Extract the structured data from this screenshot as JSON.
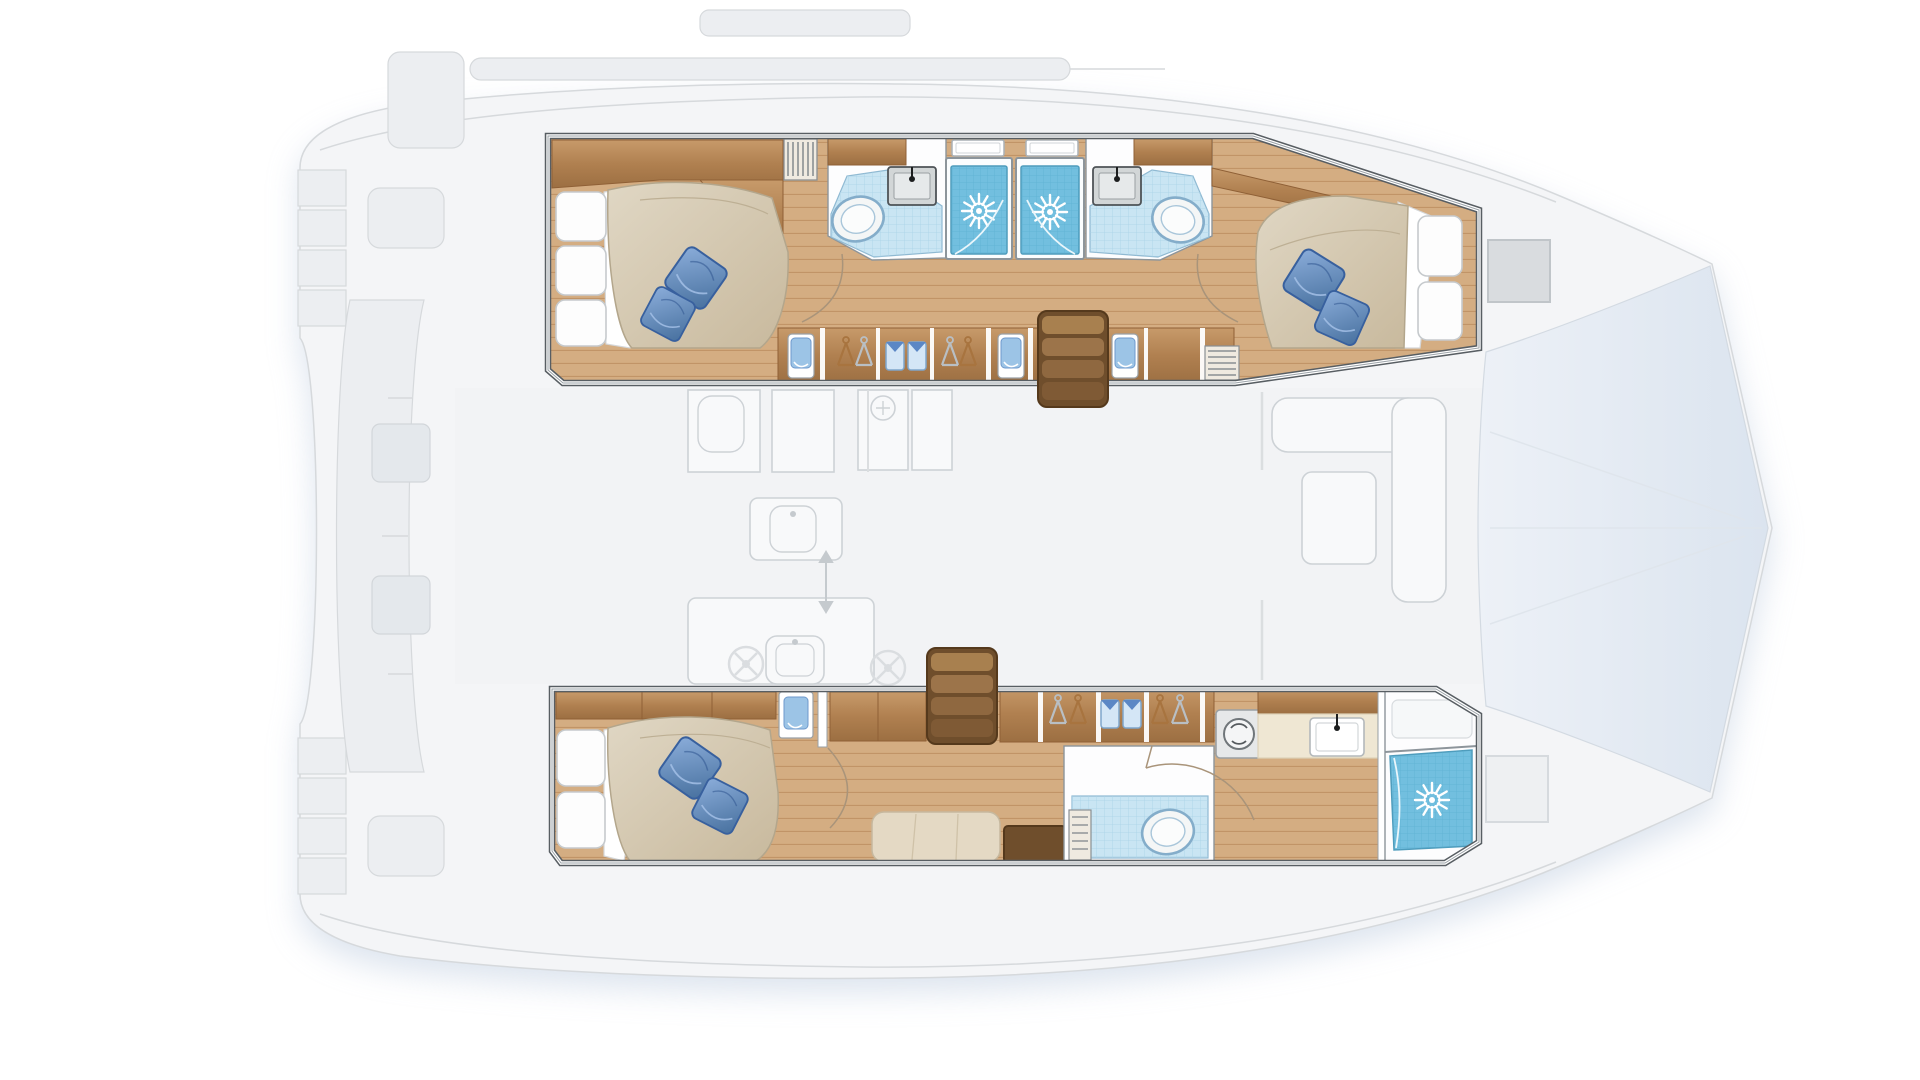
{
  "image": {
    "kind": "yacht-interior-floor-plan",
    "vessel": "sailing-catamaran",
    "view": "top-down-deck-plan",
    "orientation": "bow-right-stern-left"
  },
  "palette": {
    "wood_hi": "#c79a6a",
    "wood_mid": "#b08050",
    "wood_dark": "#8f6036",
    "wood_floor": "#d4ad82",
    "wood_floor_line": "#c19467",
    "wood_stair": "#6f4e2c",
    "duvet": "#d5c9b2",
    "duvet_line": "#b3a68c",
    "pillow_blue": "#5b87c5",
    "pillow_blue_dark": "#38609e",
    "bath_floor": "#c9e5f3",
    "shower_tile": "#72bfdf",
    "fixture_line": "#84adca",
    "sink_gray": "#d2d6d7",
    "frame_gray": "#8d959b",
    "box_border": "#585e63",
    "box_inner": "#9aa1a7",
    "fade_fill": "#f4f5f7",
    "fade_fill2": "#eceef1",
    "fade_line": "#d6d9dc",
    "salon_line": "#aab2b8",
    "shadow": "#bfcde0",
    "cream": "#efe7d3",
    "shirt_blue": "#d4e6f6",
    "hanger_tan": "#a8743f",
    "hanger_silver": "#b9bfc4"
  },
  "layout": {
    "port_hull": {
      "position": "top",
      "rooms": [
        {
          "name": "aft-cabin",
          "features": [
            "double-berth",
            "two-blue-pillows",
            "white-head-cushions",
            "overhead-lockers",
            "louvered-locker"
          ]
        },
        {
          "name": "aft-head",
          "features": [
            "toilet",
            "sink",
            "tiled-floor"
          ]
        },
        {
          "name": "aft-shower-stall",
          "features": [
            "rain-shower",
            "deck-hatch"
          ]
        },
        {
          "name": "forward-shower-stall",
          "features": [
            "rain-shower",
            "deck-hatch"
          ]
        },
        {
          "name": "forward-head",
          "features": [
            "sink",
            "toilet",
            "tiled-floor"
          ]
        },
        {
          "name": "forward-cabin",
          "features": [
            "double-berth",
            "two-blue-pillows",
            "white-head-cushions"
          ]
        },
        {
          "name": "berth-side-lockers",
          "features": [
            "hangers",
            "folded-shirts",
            "louvered-vent"
          ]
        },
        {
          "name": "companionway-stairs"
        }
      ]
    },
    "starboard_hull": {
      "position": "bottom",
      "rooms": [
        {
          "name": "owner-cabin",
          "features": [
            "double-berth",
            "two-blue-pillows",
            "white-head-cushions",
            "nightstand",
            "sofa",
            "coffee-table"
          ]
        },
        {
          "name": "companionway-stairs"
        },
        {
          "name": "wardrobe-lockers",
          "features": [
            "hangers",
            "folded-shirts"
          ]
        },
        {
          "name": "utility",
          "features": [
            "washing-machine",
            "vanity-counter",
            "sink"
          ]
        },
        {
          "name": "head",
          "features": [
            "toilet",
            "tiled-floor",
            "louvered-vent"
          ]
        },
        {
          "name": "shower-room",
          "features": [
            "rain-shower",
            "bench"
          ]
        }
      ]
    },
    "saloon": {
      "position": "center-faded",
      "features": [
        "aft-galley-counter",
        "galley-sink",
        "cooktop-burners",
        "island-sink",
        "refrigerator",
        "cabinets",
        "walkway-arrows",
        "l-shaped-sofa",
        "table",
        "forward-bulkhead"
      ]
    },
    "deck": {
      "features": [
        "cockpit-bench",
        "cockpit-tables",
        "transom-steps-port",
        "transom-steps-starboard",
        "engine-hatches",
        "boom",
        "coachroof",
        "bow-deck-hatches",
        "trampoline",
        "bridle-lines",
        "soft-shadow"
      ]
    }
  },
  "counts": {
    "cabins": 3,
    "toilets": 3,
    "shower-sunburst-heads": 3,
    "sinks_hull": 3,
    "blue_pillows": 6,
    "stairs": 2,
    "shirt_lockers": 3,
    "hanger_lockers": 5
  }
}
